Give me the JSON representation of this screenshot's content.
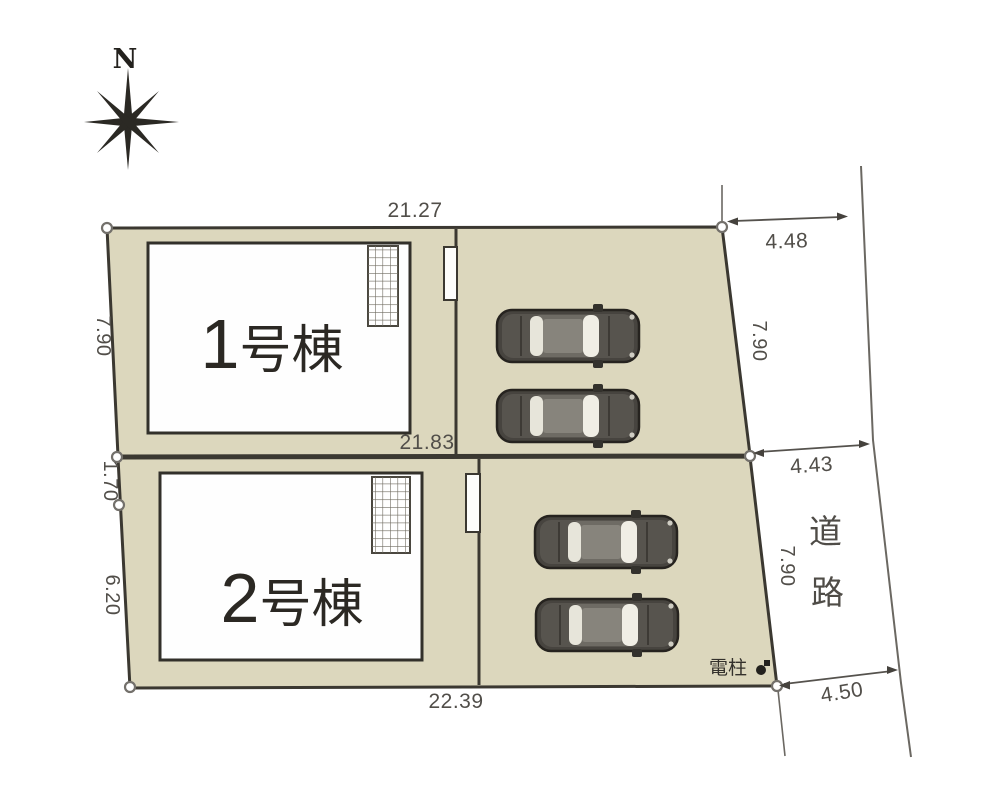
{
  "plan": {
    "compass_label": "N",
    "road": {
      "chars": [
        "道",
        "路"
      ]
    },
    "pole_label": "電柱",
    "buildings": [
      {
        "number": "1",
        "suffix": "号棟"
      },
      {
        "number": "2",
        "suffix": "号棟"
      }
    ],
    "dims": {
      "top": "21.27",
      "mid": "21.83",
      "bottom": "22.39",
      "left_upper": "7.90",
      "left_mid": "1.70",
      "left_lower": "6.20",
      "right_upper": "7.90",
      "right_lower": "7.90",
      "road_top": "4.48",
      "road_mid": "4.43",
      "road_bottom": "4.50"
    },
    "colors": {
      "lot_fill": "#dcd7bd",
      "boundary": "#3b3831",
      "thin_line": "#6b6862",
      "text": "#514e49"
    }
  }
}
